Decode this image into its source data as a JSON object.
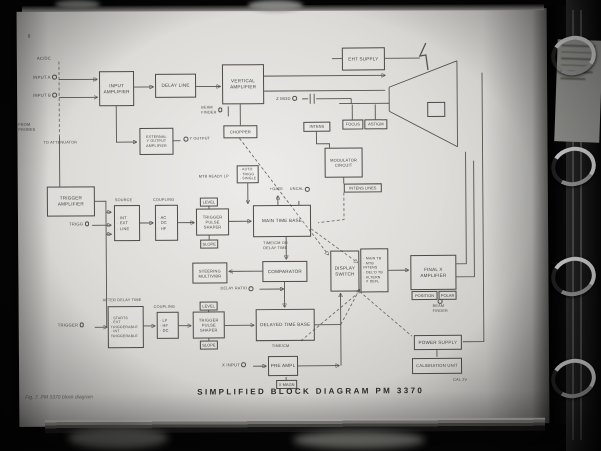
{
  "photo": {
    "page_number": "II",
    "title": "SIMPLIFIED BLOCK DIAGRAM PM 3370",
    "fig_caption": "Fig. 7. PM 3370 block diagram"
  },
  "diagram": {
    "blocks": [
      {
        "id": "input-amplifier",
        "x": 100,
        "y": 70,
        "w": 35,
        "h": 35,
        "lines": [
          "INPUT",
          "AMPLIFIER"
        ]
      },
      {
        "id": "delay-line",
        "x": 156,
        "y": 73,
        "w": 41,
        "h": 24,
        "lines": [
          "DELAY LINE"
        ]
      },
      {
        "id": "vertical-amplifier",
        "x": 223,
        "y": 64,
        "w": 42,
        "h": 40,
        "lines": [
          "VERTICAL",
          "AMPLIFIER"
        ]
      },
      {
        "id": "external-y-output-amplifier",
        "x": 140,
        "y": 127,
        "w": 34,
        "h": 27,
        "lines": [
          "EXTERNAL",
          "Y OUTPUT",
          "AMPLIFIER"
        ],
        "fs": 3.6
      },
      {
        "id": "chopper",
        "x": 224,
        "y": 125,
        "w": 34,
        "h": 13,
        "lines": [
          "CHOPPER"
        ],
        "fs": 4
      },
      {
        "id": "eht-supply",
        "x": 343,
        "y": 48,
        "w": 43,
        "h": 23,
        "lines": [
          "EHT SUPPLY"
        ]
      },
      {
        "id": "modulator-circuit",
        "x": 325,
        "y": 148,
        "w": 38,
        "h": 30,
        "lines": [
          "MODULATOR",
          "CIRCUIT"
        ],
        "fs": 4
      },
      {
        "id": "trigger-amplifier",
        "x": 47,
        "y": 185,
        "w": 48,
        "h": 30,
        "lines": [
          "TRIGGER",
          "AMPLIFIER"
        ]
      },
      {
        "id": "trigger-pulse-shaper-mtb",
        "x": 196,
        "y": 208,
        "w": 33,
        "h": 27,
        "lines": [
          "TRIGGER",
          "PULSE",
          "SHAPER"
        ],
        "fs": 4
      },
      {
        "id": "main-time-base",
        "x": 253,
        "y": 205,
        "w": 58,
        "h": 32,
        "lines": [
          "MAIN TIME BASE"
        ]
      },
      {
        "id": "steering-multivibr",
        "x": 192,
        "y": 262,
        "w": 35,
        "h": 21,
        "lines": [
          "STEERING",
          "MULTIVIBR"
        ],
        "fs": 4
      },
      {
        "id": "comparator",
        "x": 262,
        "y": 261,
        "w": 45,
        "h": 21,
        "lines": [
          "COMPARATOR"
        ]
      },
      {
        "id": "trigger-pulse-shaper-dtb",
        "x": 192,
        "y": 311,
        "w": 32,
        "h": 27,
        "lines": [
          "TRIGGER",
          "PULSE",
          "SHAPER"
        ],
        "fs": 4
      },
      {
        "id": "delayed-time-base",
        "x": 255,
        "y": 309,
        "w": 59,
        "h": 32,
        "lines": [
          "DELAYED TIME BASE"
        ]
      },
      {
        "id": "pre-ampl",
        "x": 267,
        "y": 356,
        "w": 30,
        "h": 20,
        "lines": [
          "PRE AMPL"
        ]
      },
      {
        "id": "display-switch",
        "x": 330,
        "y": 251,
        "w": 29,
        "h": 41,
        "lines": [
          "DISPLAY",
          "SWITCH"
        ]
      },
      {
        "id": "final-x-amplifier",
        "x": 410,
        "y": 256,
        "w": 46,
        "h": 35,
        "lines": [
          "FINAL X",
          "AMPLIFIER"
        ]
      },
      {
        "id": "power-supply",
        "x": 413,
        "y": 336,
        "w": 48,
        "h": 15,
        "lines": [
          "POWER SUPPLY"
        ]
      },
      {
        "id": "calibration-unit",
        "x": 411,
        "y": 359,
        "w": 50,
        "h": 16,
        "lines": [
          "CALIBRATION UNIT"
        ],
        "fs": 4.2
      },
      {
        "id": "crt-connector",
        "x": 428,
        "y": 103,
        "w": 18,
        "h": 15,
        "lines": []
      }
    ],
    "option_blocks": [
      {
        "id": "mtb-mode",
        "x": 237,
        "y": 165,
        "w": 22,
        "h": 18,
        "options": [
          "AUTO",
          "TRIGG",
          "SINGLE"
        ],
        "fs": 3.5
      },
      {
        "id": "trigger-source",
        "x": 114,
        "y": 204,
        "w": 26,
        "h": 36,
        "options": [
          "INT",
          "EXT",
          "LINE"
        ]
      },
      {
        "id": "trigger-coupling-mtb",
        "x": 155,
        "y": 204,
        "w": 23,
        "h": 36,
        "options": [
          "AC",
          "DC",
          "HF"
        ]
      },
      {
        "id": "dtb-start-mode",
        "x": 107,
        "y": 305,
        "w": 36,
        "h": 42,
        "options": [
          "STARTS",
          "EXT TRIGGERABLE",
          "INT TRIGGERABLE"
        ],
        "fs": 3.5,
        "wrap": true
      },
      {
        "id": "trigger-coupling-dtb",
        "x": 156,
        "y": 311,
        "w": 22,
        "h": 27,
        "options": [
          "LF",
          "HF",
          "DC"
        ]
      },
      {
        "id": "display-modes",
        "x": 360,
        "y": 249,
        "w": 28,
        "h": 44,
        "options": [
          "MAIN TB",
          "MTB INTENS",
          "DEL'D TB",
          "ALTERN",
          "X DEFL"
        ],
        "fs": 3.5
      }
    ],
    "small_boxes": [
      {
        "id": "level-mtb",
        "x": 200,
        "y": 197,
        "w": 18,
        "h": 9,
        "text": "LEVEL"
      },
      {
        "id": "slope-mtb",
        "x": 200,
        "y": 239,
        "w": 18,
        "h": 9,
        "text": "SLOPE"
      },
      {
        "id": "level-dtb",
        "x": 199,
        "y": 301,
        "w": 18,
        "h": 9,
        "text": "LEVEL"
      },
      {
        "id": "slope-dtb",
        "x": 199,
        "y": 340,
        "w": 18,
        "h": 9,
        "text": "SLOPE"
      },
      {
        "id": "intens",
        "x": 304,
        "y": 122,
        "w": 27,
        "h": 10,
        "text": "INTENS"
      },
      {
        "id": "focus",
        "x": 343,
        "y": 120,
        "w": 21,
        "h": 10,
        "text": "FOCUS"
      },
      {
        "id": "astigm",
        "x": 365,
        "y": 120,
        "w": 23,
        "h": 10,
        "text": "ASTIGM"
      },
      {
        "id": "position",
        "x": 411,
        "y": 292,
        "w": 26,
        "h": 9,
        "text": "POSITION"
      },
      {
        "id": "polar",
        "x": 438,
        "y": 292,
        "w": 18,
        "h": 9,
        "text": "POLAR"
      },
      {
        "id": "x-magn",
        "x": 275,
        "y": 380,
        "w": 21,
        "h": 9,
        "text": "X MAGN"
      },
      {
        "id": "intens-lines",
        "x": 344,
        "y": 184,
        "w": 38,
        "h": 9,
        "text": "INTENS LINES"
      }
    ],
    "labels": [
      {
        "id": "ac-dc",
        "x": 38,
        "y": 54,
        "lines": [
          "AC/DC"
        ]
      },
      {
        "id": "input-a",
        "x": 34,
        "y": 73,
        "lines": [
          "INPUT A"
        ],
        "jack": "right"
      },
      {
        "id": "input-b",
        "x": 34,
        "y": 91,
        "lines": [
          "INPUT B"
        ],
        "jack": "right"
      },
      {
        "id": "from-probes",
        "x": 19,
        "y": 121,
        "lines": [
          "FROM",
          "PROBES"
        ],
        "fs": 3.8
      },
      {
        "id": "to-attenuator",
        "x": 44,
        "y": 139,
        "lines": [
          "TO ATTENUATOR"
        ],
        "fs": 3.8
      },
      {
        "id": "beam-finder-y",
        "x": 202,
        "y": 105,
        "lines": [
          "BEAM",
          "FINDER"
        ],
        "jack": "right",
        "fs": 3.8
      },
      {
        "id": "y-output",
        "x": 184,
        "y": 136,
        "lines": [
          "Y OUTPUT"
        ],
        "jack": "left",
        "fs": 3.8
      },
      {
        "id": "z-mod",
        "x": 277,
        "y": 96,
        "lines": [
          "Z MOD"
        ],
        "jack": "right"
      },
      {
        "id": "mtb-ready",
        "x": 199,
        "y": 174,
        "lines": [
          "MTB READY LP"
        ],
        "fs": 3.8
      },
      {
        "id": "gate",
        "x": 270,
        "y": 187,
        "lines": [
          "+GATE"
        ],
        "fs": 3.8
      },
      {
        "id": "uncal",
        "x": 290,
        "y": 187,
        "lines": [
          "UNCAL"
        ],
        "jack": "right",
        "fs": 3.8
      },
      {
        "id": "source",
        "x": 115,
        "y": 197,
        "lines": [
          "SOURCE"
        ],
        "fs": 3.8
      },
      {
        "id": "coupling-mtb",
        "x": 153,
        "y": 197,
        "lines": [
          "COUPLING"
        ],
        "fs": 3.8
      },
      {
        "id": "trigg",
        "x": 69,
        "y": 220,
        "lines": [
          "TRIGG"
        ],
        "jack": "right"
      },
      {
        "id": "timebase-mtb",
        "x": 263,
        "y": 241,
        "lines": [
          "TIME/CM OR",
          "DELAY TIME"
        ],
        "fs": 3.8
      },
      {
        "id": "delay-ratio",
        "x": 220,
        "y": 286,
        "lines": [
          "DELAY RATIO"
        ],
        "jack": "right",
        "fs": 3.8
      },
      {
        "id": "after-delay",
        "x": 102,
        "y": 297,
        "lines": [
          "AFTER DELAY TIME"
        ],
        "fs": 3.8
      },
      {
        "id": "coupling-dtb",
        "x": 153,
        "y": 304,
        "lines": [
          "COUPLING"
        ],
        "fs": 3.8
      },
      {
        "id": "trigger-dtb",
        "x": 57,
        "y": 321,
        "lines": [
          "TRIGGER"
        ],
        "jack": "right"
      },
      {
        "id": "timebase-dtb",
        "x": 271,
        "y": 344,
        "lines": [
          "TIME/CM"
        ],
        "fs": 3.8
      },
      {
        "id": "x-input",
        "x": 221,
        "y": 362,
        "lines": [
          "X INPUT"
        ],
        "jack": "right"
      },
      {
        "id": "beam-finder-x",
        "x": 432,
        "y": 300,
        "lines": [
          "BEAM",
          "FINDER"
        ],
        "jack": "top",
        "fs": 3.8
      },
      {
        "id": "cal",
        "x": 452,
        "y": 379,
        "lines": [
          "CAL 2V"
        ],
        "fs": 3.8
      }
    ]
  }
}
